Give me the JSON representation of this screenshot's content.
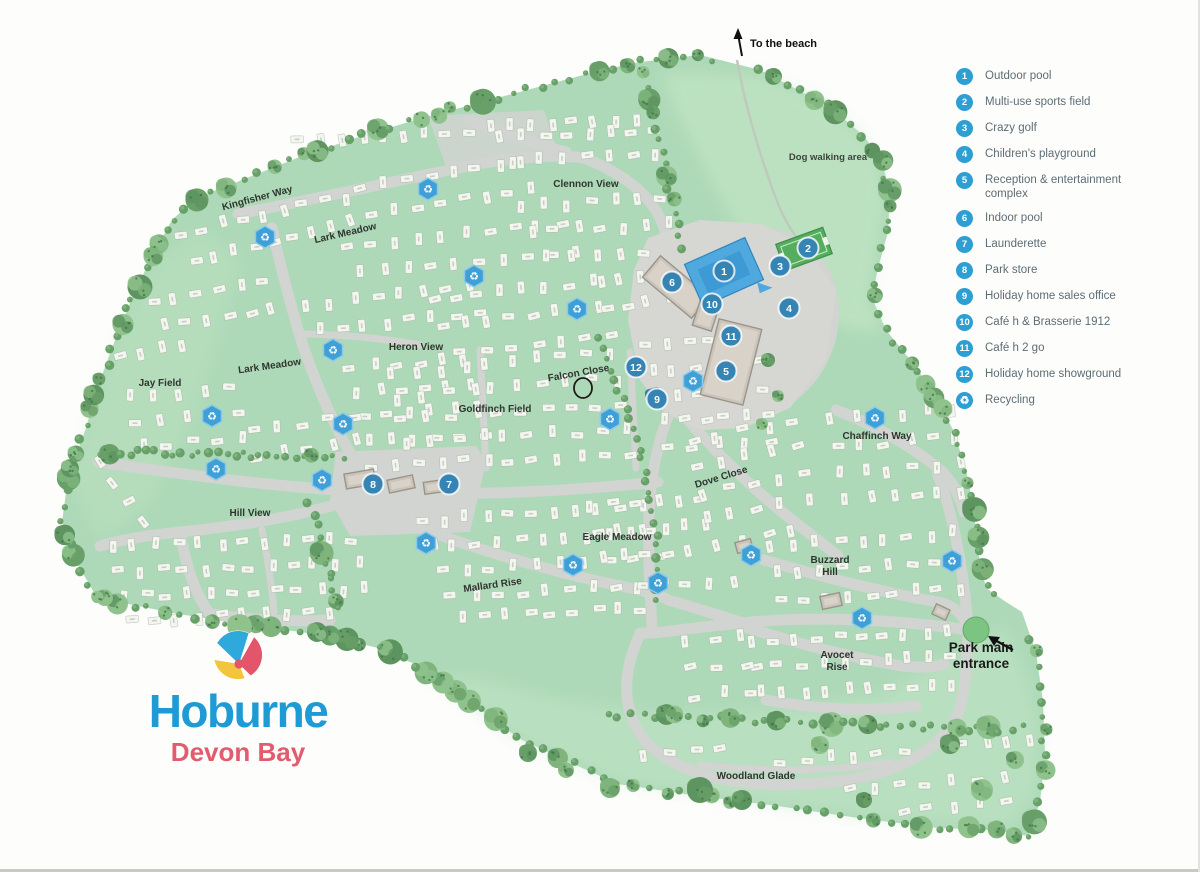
{
  "logo": {
    "name": "Hoburne",
    "subname": "Devon Bay",
    "name_color": "#1e9bd4",
    "subname_color": "#e25b6e"
  },
  "legend": {
    "accent": "#2d9fd2",
    "items": [
      {
        "num": "1",
        "label": "Outdoor pool"
      },
      {
        "num": "2",
        "label": "Multi-use sports field"
      },
      {
        "num": "3",
        "label": "Crazy golf"
      },
      {
        "num": "4",
        "label": "Children's playground"
      },
      {
        "num": "5",
        "label": "Reception & entertainment complex"
      },
      {
        "num": "6",
        "label": "Indoor pool"
      },
      {
        "num": "7",
        "label": "Launderette"
      },
      {
        "num": "8",
        "label": "Park store"
      },
      {
        "num": "9",
        "label": "Holiday home sales office"
      },
      {
        "num": "10",
        "label": "Café h & Brasserie 1912"
      },
      {
        "num": "11",
        "label": "Café h 2 go"
      },
      {
        "num": "12",
        "label": "Holiday home showground"
      }
    ],
    "recycling_label": "Recycling",
    "recycling_icon": "♻"
  },
  "map": {
    "marker_color": "#3684b4",
    "recycle_color": "#3fa0d8",
    "park_green": "#aed9b8",
    "pool_blue": "#4fa9de",
    "field_green": "#54ae5e",
    "recycling_icon": "♻",
    "annotations": {
      "to_the_beach": {
        "text": "To the beach",
        "x": 750,
        "y": 47
      },
      "dog_walking_area": {
        "text": "Dog walking area",
        "x": 828,
        "y": 160
      },
      "park_main_entrance": {
        "lines": [
          "Park main",
          "entrance"
        ],
        "x": 981,
        "y": 652
      }
    },
    "streets": [
      {
        "id": "kingfisher-way",
        "name": "Kingfisher Way",
        "x": 258,
        "y": 201,
        "rot": -15
      },
      {
        "id": "lark-meadow-n",
        "name": "Lark Meadow",
        "x": 346,
        "y": 236,
        "rot": -13
      },
      {
        "id": "clennon-view",
        "name": "Clennon View",
        "x": 586,
        "y": 187,
        "rot": 0
      },
      {
        "id": "heron-view",
        "name": "Heron View",
        "x": 416,
        "y": 350,
        "rot": 0
      },
      {
        "id": "falcon-close",
        "name": "Falcon Close",
        "x": 579,
        "y": 376,
        "rot": -10
      },
      {
        "id": "goldfinch-field",
        "name": "Goldfinch Field",
        "x": 495,
        "y": 412,
        "rot": 0
      },
      {
        "id": "lark-meadow-s",
        "name": "Lark Meadow",
        "x": 270,
        "y": 369,
        "rot": -8
      },
      {
        "id": "jay-field",
        "name": "Jay Field",
        "x": 160,
        "y": 386,
        "rot": 0
      },
      {
        "id": "hill-view",
        "name": "Hill View",
        "x": 250,
        "y": 516,
        "rot": 0
      },
      {
        "id": "mallard-rise",
        "name": "Mallard Rise",
        "x": 493,
        "y": 588,
        "rot": -8
      },
      {
        "id": "eagle-meadow",
        "name": "Eagle Meadow",
        "x": 617,
        "y": 540,
        "rot": 0
      },
      {
        "id": "dove-close",
        "name": "Dove Close",
        "x": 722,
        "y": 480,
        "rot": -17
      },
      {
        "id": "chaffinch-way",
        "name": "Chaffinch Way",
        "x": 877,
        "y": 439,
        "rot": 0
      },
      {
        "id": "buzzard-hill",
        "name": "Buzzard Hill",
        "x": 830,
        "y": 563,
        "rot": 0,
        "lines": [
          "Buzzard",
          "Hill"
        ]
      },
      {
        "id": "avocet-rise",
        "name": "Avocet Rise",
        "x": 837,
        "y": 658,
        "rot": 0,
        "lines": [
          "Avocet",
          "Rise"
        ]
      },
      {
        "id": "woodland-glade",
        "name": "Woodland Glade",
        "x": 756,
        "y": 779,
        "rot": 0
      }
    ],
    "facilities": [
      {
        "n": "1",
        "x": 724,
        "y": 271
      },
      {
        "n": "2",
        "x": 808,
        "y": 248
      },
      {
        "n": "3",
        "x": 780,
        "y": 266
      },
      {
        "n": "4",
        "x": 789,
        "y": 308
      },
      {
        "n": "5",
        "x": 726,
        "y": 371
      },
      {
        "n": "6",
        "x": 672,
        "y": 282
      },
      {
        "n": "7",
        "x": 449,
        "y": 484
      },
      {
        "n": "8",
        "x": 373,
        "y": 484
      },
      {
        "n": "9",
        "x": 657,
        "y": 399
      },
      {
        "n": "10",
        "x": 712,
        "y": 304
      },
      {
        "n": "11",
        "x": 731,
        "y": 336
      },
      {
        "n": "12",
        "x": 636,
        "y": 367
      }
    ],
    "recycling_points": [
      [
        428,
        189
      ],
      [
        265,
        237
      ],
      [
        474,
        276
      ],
      [
        577,
        309
      ],
      [
        333,
        350
      ],
      [
        693,
        381
      ],
      [
        212,
        416
      ],
      [
        343,
        424
      ],
      [
        610,
        419
      ],
      [
        216,
        469
      ],
      [
        322,
        480
      ],
      [
        426,
        543
      ],
      [
        573,
        565
      ],
      [
        658,
        583
      ],
      [
        875,
        418
      ],
      [
        751,
        555
      ],
      [
        952,
        561
      ],
      [
        862,
        618
      ]
    ]
  }
}
